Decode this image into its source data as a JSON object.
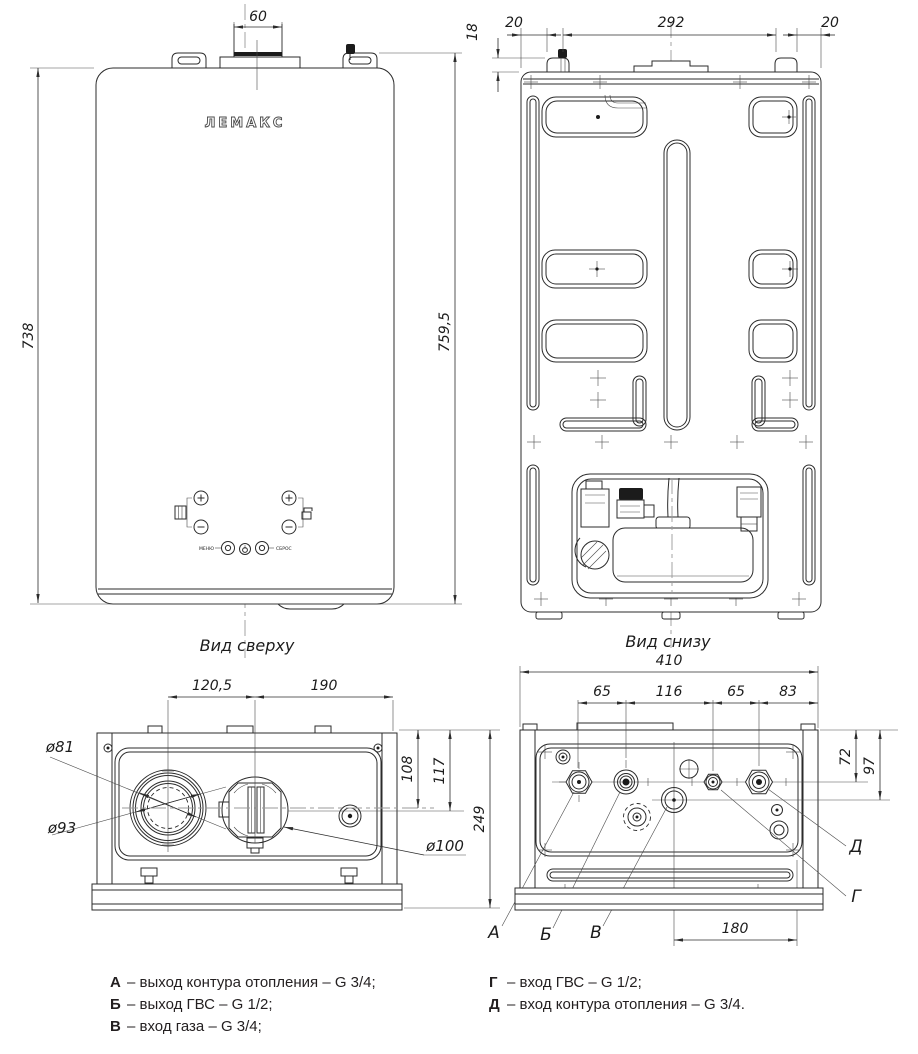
{
  "front_view": {
    "logo": "ЛЕМАКС",
    "dims": {
      "flue_width": "60",
      "height_left": "738",
      "height_right": "759,5"
    },
    "controls": {
      "menu": "МЕНЮ",
      "reset": "СБРОС"
    }
  },
  "back_view": {
    "dims": {
      "hook_depth": "18",
      "left_offset": "20",
      "hook_span": "292",
      "right_offset": "20"
    }
  },
  "top_view": {
    "label": "Вид сверху",
    "dims": {
      "flue_center": "120,5",
      "flue_to_edge": "190",
      "d81": "ø81",
      "d93": "ø93",
      "d100": "ø100",
      "v108": "108",
      "v117": "117",
      "depth": "249"
    }
  },
  "bottom_view": {
    "label": "Вид снизу",
    "dims": {
      "width": "410",
      "a_b": "65",
      "b_g": "116",
      "g_d": "65",
      "d_edge": "83",
      "v72": "72",
      "v97": "97",
      "gas_edge": "180"
    },
    "ports": {
      "a": "А",
      "b": "Б",
      "v": "В",
      "g": "Г",
      "d": "Д"
    }
  },
  "legend": {
    "left": [
      {
        "letter": "А",
        "text": "–  выход контура отопления – G 3/4;"
      },
      {
        "letter": "Б",
        "text": "–  выход ГВС – G 1/2;"
      },
      {
        "letter": "В",
        "text": "–  вход газа – G 3/4;"
      }
    ],
    "right": [
      {
        "letter": "Г",
        "text": "–  вход ГВС – G 1/2;"
      },
      {
        "letter": "Д",
        "text": "–  вход контура отопления – G 3/4."
      }
    ]
  }
}
